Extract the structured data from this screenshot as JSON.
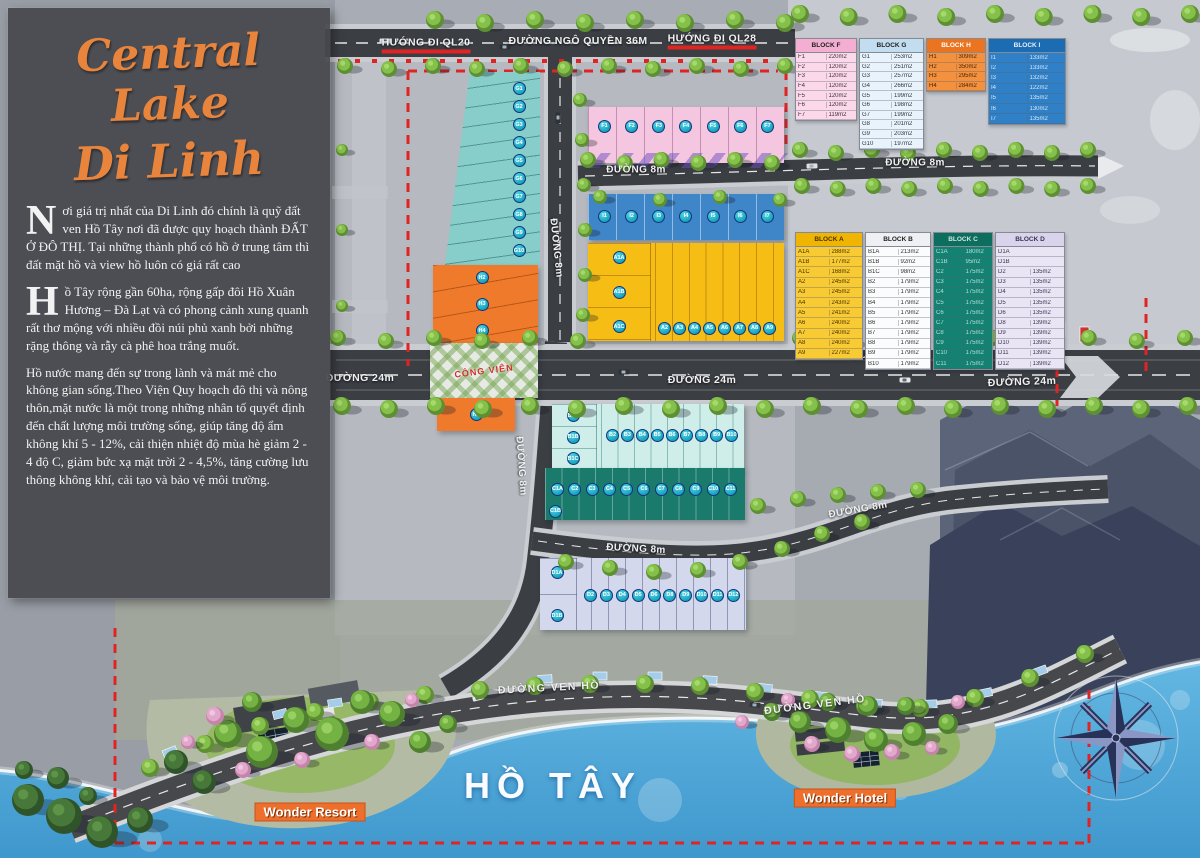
{
  "title": {
    "line1": "Central Lake",
    "line2": "Di Linh"
  },
  "intro": {
    "p1_dropcap": "N",
    "p1": "ơi giá trị nhất của Di Linh đó chính là quỹ đất ven Hồ Tây nơi đã được quy hoạch thành ĐẤT Ở ĐÔ THỊ. Tại những thành phố có hồ ở trung tâm thì đất mặt hồ và view hồ luôn có giá rất cao",
    "p2_dropcap": "H",
    "p2": "ồ Tây rộng gần 60ha, rộng gấp đôi Hồ Xuân Hương – Đà Lạt và có phong cảnh xung quanh rất thơ mộng với nhiều đồi núi phủ xanh bởi những rặng thông và rẫy cà phê hoa trắng muốt.",
    "p3": "Hồ nước mang đến sự trong lành và mát mẻ cho không gian sống.Theo Viện Quy hoạch đô thị và nông thôn,mặt nước là một trong những nhân tố quyết định đến chất lượng môi trường sống, giúp tăng độ ẩm không khí 5 - 12%, cải thiện nhiệt độ mùa hè giảm 2 - 4 độ C, giảm bức xạ mặt trời 2 - 4,5%, tăng cường lưu thông không khí, cải tạo và bảo vệ môi trường."
  },
  "road_labels": {
    "ql20": "HƯỚNG ĐI QL20",
    "ngo_quyen": "ĐƯỜNG NGÔ QUYỀN 36M",
    "ql28": "HƯỚNG ĐI QL28",
    "d8": "ĐƯỜNG 8m",
    "d24": "ĐƯỜNG 24m",
    "ven_ho": "ĐƯỜNG VEN HỒ"
  },
  "map_labels": {
    "lake": "HỒ TÂY",
    "park": "CÔNG VIÊN",
    "resort": "Wonder Resort",
    "hotel": "Wonder Hotel"
  },
  "tables": {
    "F": {
      "name": "BLOCK F",
      "rows": [
        [
          "F1",
          "220m2"
        ],
        [
          "F2",
          "120m2"
        ],
        [
          "F3",
          "120m2"
        ],
        [
          "F4",
          "120m2"
        ],
        [
          "F5",
          "120m2"
        ],
        [
          "F6",
          "120m2"
        ],
        [
          "F7",
          "119m2"
        ]
      ]
    },
    "G": {
      "name": "BLOCK G",
      "rows": [
        [
          "G1",
          "253m2"
        ],
        [
          "G2",
          "251m2"
        ],
        [
          "G3",
          "257m2"
        ],
        [
          "G4",
          "266m2"
        ],
        [
          "G5",
          "199m2"
        ],
        [
          "G6",
          "198m2"
        ],
        [
          "G7",
          "199m2"
        ],
        [
          "G8",
          "201m2"
        ],
        [
          "G9",
          "203m2"
        ],
        [
          "G10",
          "197m2"
        ]
      ]
    },
    "H": {
      "name": "BLOCK H",
      "rows": [
        [
          "H1",
          "309m2"
        ],
        [
          "H2",
          "350m2"
        ],
        [
          "H3",
          "295m2"
        ],
        [
          "H4",
          "284m2"
        ]
      ]
    },
    "I": {
      "name": "BLOCK I",
      "rows": [
        [
          "I1",
          "133m2"
        ],
        [
          "I2",
          "133m2"
        ],
        [
          "I3",
          "132m2"
        ],
        [
          "I4",
          "122m2"
        ],
        [
          "I5",
          "135m2"
        ],
        [
          "I6",
          "130m2"
        ],
        [
          "I7",
          "135m2"
        ]
      ]
    },
    "A": {
      "name": "BLOCK A",
      "rows": [
        [
          "A1A",
          "288m2"
        ],
        [
          "A1B",
          "177m2"
        ],
        [
          "A1C",
          "168m2"
        ],
        [
          "A2",
          "245m2"
        ],
        [
          "A3",
          "245m2"
        ],
        [
          "A4",
          "243m2"
        ],
        [
          "A5",
          "241m2"
        ],
        [
          "A6",
          "240m2"
        ],
        [
          "A7",
          "240m2"
        ],
        [
          "A8",
          "240m2"
        ],
        [
          "A9",
          "227m2"
        ]
      ]
    },
    "B": {
      "name": "BLOCK B",
      "rows": [
        [
          "B1A",
          "213m2"
        ],
        [
          "B1B",
          "92m2"
        ],
        [
          "B1C",
          "98m2"
        ],
        [
          "B2",
          "179m2"
        ],
        [
          "B3",
          "179m2"
        ],
        [
          "B4",
          "179m2"
        ],
        [
          "B5",
          "179m2"
        ],
        [
          "B6",
          "179m2"
        ],
        [
          "B7",
          "179m2"
        ],
        [
          "B8",
          "179m2"
        ],
        [
          "B9",
          "179m2"
        ],
        [
          "B10",
          "179m2"
        ]
      ]
    },
    "C": {
      "name": "BLOCK C",
      "rows": [
        [
          "C1A",
          "180m2"
        ],
        [
          "C1B",
          "95m2"
        ],
        [
          "C2",
          "175m2"
        ],
        [
          "C3",
          "175m2"
        ],
        [
          "C4",
          "175m2"
        ],
        [
          "C5",
          "175m2"
        ],
        [
          "C6",
          "175m2"
        ],
        [
          "C7",
          "175m2"
        ],
        [
          "C8",
          "175m2"
        ],
        [
          "C9",
          "175m2"
        ],
        [
          "C10",
          "175m2"
        ],
        [
          "C11",
          "175m2"
        ]
      ]
    },
    "D": {
      "name": "BLOCK D",
      "rows": [
        [
          "D1A",
          ""
        ],
        [
          "D1B",
          ""
        ],
        [
          "D2",
          "135m2"
        ],
        [
          "D3",
          "135m2"
        ],
        [
          "D4",
          "135m2"
        ],
        [
          "D5",
          "135m2"
        ],
        [
          "D6",
          "135m2"
        ],
        [
          "D8",
          "139m2"
        ],
        [
          "D9",
          "139m2"
        ],
        [
          "D10",
          "139m2"
        ],
        [
          "D11",
          "139m2"
        ],
        [
          "D12",
          "139m2"
        ]
      ]
    }
  },
  "map_lots": {
    "G_strip": [
      "G1",
      "G2",
      "G3",
      "G4",
      "G5",
      "G6",
      "G7",
      "G8",
      "G9",
      "G10"
    ],
    "H_strip": [
      "H2",
      "H3",
      "H4"
    ],
    "H_single": [
      "H1"
    ],
    "F_row": [
      "F1",
      "F2",
      "F3",
      "F4",
      "F5",
      "F6",
      "F7"
    ],
    "I_row": [
      "I1",
      "I2",
      "I3",
      "I4",
      "I5",
      "I6",
      "I7"
    ],
    "A_left": [
      "A1A",
      "A1B",
      "A1C"
    ],
    "A_row": [
      "A2",
      "A3",
      "A4",
      "A5",
      "A6",
      "A7",
      "A8",
      "A9"
    ],
    "B_left": [
      "B1A",
      "B1B",
      "B1C"
    ],
    "B_row": [
      "B2",
      "B3",
      "B4",
      "B5",
      "B6",
      "B7",
      "B8",
      "B9",
      "B10"
    ],
    "C_row": [
      "C1A",
      "C2",
      "C3",
      "C4",
      "C5",
      "C6",
      "C7",
      "C8",
      "C9",
      "C10",
      "C11"
    ],
    "C_single": [
      "C1B"
    ],
    "D_left": [
      "D1A",
      "D1B"
    ],
    "D_row": [
      "D2",
      "D3",
      "D4",
      "D5",
      "D6",
      "D8",
      "D9",
      "D10",
      "D11",
      "D12"
    ]
  },
  "colors": {
    "brand_orange": "#E8843C",
    "boundary_red": "#E02424",
    "lake_blue": "#58B0DD",
    "block_g_teal": "#87CDC9",
    "block_h_orange": "#EF7A2C",
    "block_f_pink": "#F5C6E0",
    "block_i_blue": "#3F86C8",
    "block_a_yellow": "#F6BD15",
    "block_b_cyan": "#CFEEEA",
    "block_c_teal": "#1A7A6C",
    "block_d_lavender": "#D3D8EC"
  }
}
